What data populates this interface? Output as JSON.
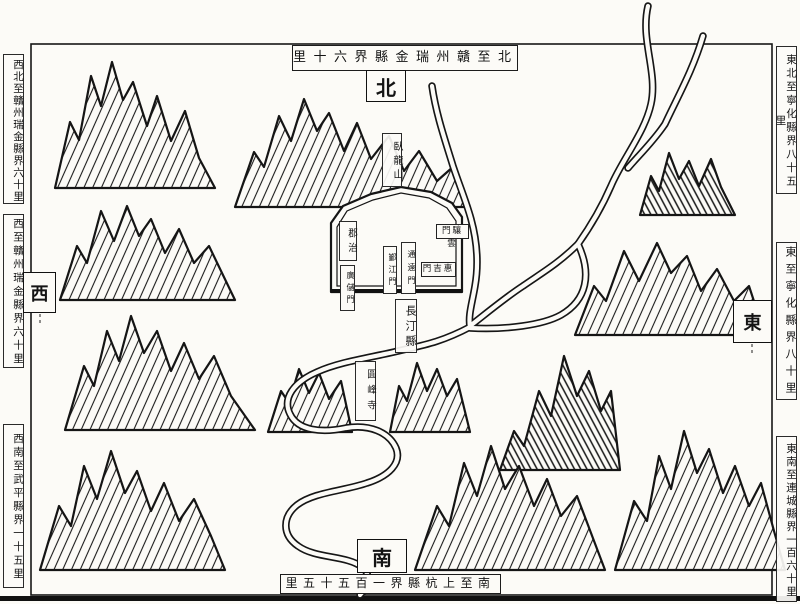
{
  "palette": {
    "ink": "#141414",
    "paper": "#fcfbf7"
  },
  "compass": {
    "north": "北",
    "south": "南",
    "east": "東",
    "west": "西"
  },
  "border_notes": {
    "top": "北至贛州瑞金縣界六十里",
    "bottom": "南至上杭縣界一百五十五里",
    "left": [
      {
        "id": "northwest",
        "text": "西北至贛州瑞金縣界六十里"
      },
      {
        "id": "west",
        "text": "西至贛州瑞金縣界六十里"
      },
      {
        "id": "southwest",
        "text": "西南至武平縣界一十五里"
      }
    ],
    "right": [
      {
        "id": "northeast",
        "text": "東北至寧化縣界八十五里"
      },
      {
        "id": "east",
        "text": "東至寧化縣界八十里"
      },
      {
        "id": "southeast",
        "text": "東南至連城縣界一百六十里"
      }
    ]
  },
  "map_labels": {
    "mountain_wolong": "臥龍山",
    "prefecture_seat": "郡治",
    "gate_guangchu": "廣儲門",
    "gate_yinjiang": "鄞江門",
    "gate_tongyuan": "通遠門",
    "gate_yunxiang": "雲驤門",
    "gate_huiji": "惠吉門",
    "county_changting": "長汀縣",
    "temple": "圓峰寺"
  }
}
